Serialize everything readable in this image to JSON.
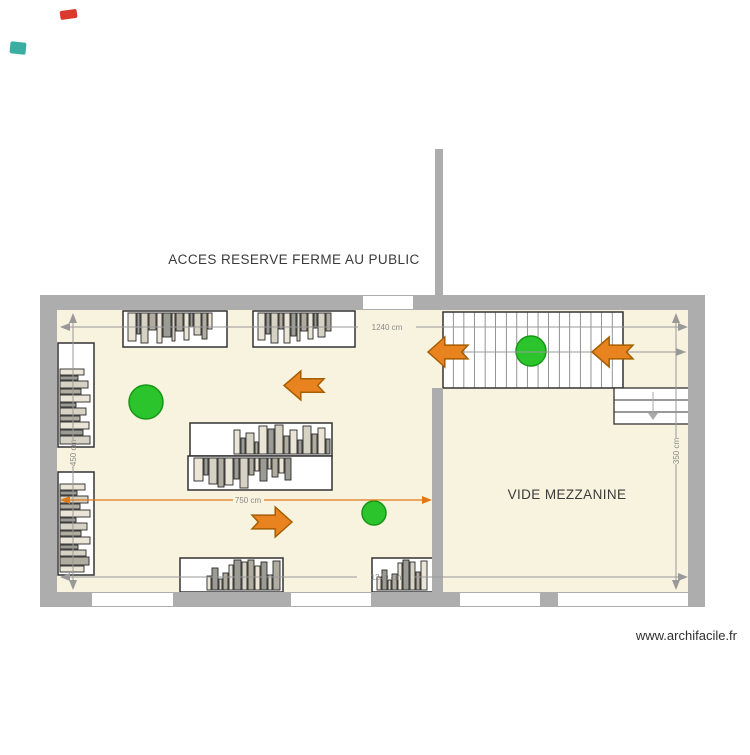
{
  "labels": {
    "access_note": "ACCES RESERVE FERME AU PUBLIC",
    "mezzanine": "VIDE MEZZANINE",
    "watermark": "www.archifacile.fr"
  },
  "dimensions": {
    "top": "1240 cm",
    "bottom": "1240 cm",
    "left": "450 cm",
    "right": "350 cm",
    "room": "750 cm"
  },
  "colors": {
    "wall": "#adadad",
    "floor": "#f8f3de",
    "outline": "#333333",
    "dim_line": "#999999",
    "dim_line_orange": "#e07818",
    "marker_green": "#2cc42c",
    "marker_green_border": "#169616",
    "arrow_orange": "#e8831f",
    "arrow_orange_border": "#a55e00",
    "artifact_red": "#d93a2b",
    "artifact_teal": "#3aaea0"
  },
  "plan": {
    "book_palette": [
      "#eae5d6",
      "#9c9c94",
      "#d6d2c4",
      "#b0aca0"
    ],
    "furniture": [
      {
        "name": "bookshelf-top-left",
        "x": 123,
        "y": 311,
        "w": 104,
        "h": 36,
        "side": "top",
        "books": [
          [
            5,
            8,
            28
          ],
          [
            14,
            3,
            21
          ],
          [
            18,
            7,
            30
          ],
          [
            26,
            7,
            17
          ],
          [
            34,
            5,
            30
          ],
          [
            40,
            8,
            24
          ],
          [
            49,
            3,
            28
          ],
          [
            53,
            7,
            18
          ],
          [
            61,
            5,
            27
          ],
          [
            67,
            3,
            14
          ],
          [
            71,
            7,
            22
          ],
          [
            79,
            5,
            26
          ],
          [
            85,
            4,
            16
          ]
        ]
      },
      {
        "name": "bookshelf-top-right",
        "x": 253,
        "y": 311,
        "w": 102,
        "h": 36,
        "side": "top",
        "books": [
          [
            5,
            7,
            27
          ],
          [
            13,
            4,
            21
          ],
          [
            18,
            7,
            30
          ],
          [
            26,
            4,
            16
          ],
          [
            31,
            6,
            30
          ],
          [
            38,
            5,
            23
          ],
          [
            44,
            3,
            28
          ],
          [
            48,
            6,
            18
          ],
          [
            55,
            5,
            26
          ],
          [
            61,
            3,
            15
          ],
          [
            65,
            7,
            24
          ],
          [
            73,
            5,
            18
          ]
        ]
      },
      {
        "name": "bookshelf-left-wall-upper",
        "x": 58,
        "y": 343,
        "w": 36,
        "h": 104,
        "side": "left",
        "books": [
          [
            26,
            24,
            6
          ],
          [
            33,
            18,
            4
          ],
          [
            38,
            28,
            7
          ],
          [
            46,
            21,
            5
          ],
          [
            52,
            30,
            7
          ],
          [
            60,
            16,
            4
          ],
          [
            65,
            26,
            7
          ],
          [
            73,
            20,
            5
          ],
          [
            79,
            29,
            7
          ],
          [
            87,
            23,
            5
          ],
          [
            93,
            30,
            8
          ]
        ]
      },
      {
        "name": "bookshelf-left-wall-lower",
        "x": 58,
        "y": 472,
        "w": 36,
        "h": 103,
        "side": "left",
        "books": [
          [
            12,
            25,
            6
          ],
          [
            19,
            17,
            4
          ],
          [
            24,
            28,
            7
          ],
          [
            32,
            20,
            5
          ],
          [
            38,
            30,
            7
          ],
          [
            46,
            16,
            4
          ],
          [
            51,
            27,
            7
          ],
          [
            59,
            21,
            5
          ],
          [
            65,
            30,
            7
          ],
          [
            73,
            18,
            4
          ],
          [
            78,
            26,
            6
          ],
          [
            85,
            29,
            8
          ],
          [
            94,
            24,
            6
          ]
        ]
      },
      {
        "name": "bookshelf-center-upper",
        "x": 190,
        "y": 423,
        "w": 142,
        "h": 33,
        "side": "bottom",
        "books": [
          [
            44,
            6,
            24
          ],
          [
            51,
            4,
            16
          ],
          [
            56,
            8,
            21
          ],
          [
            65,
            3,
            12
          ],
          [
            69,
            8,
            28
          ],
          [
            78,
            6,
            25
          ],
          [
            85,
            8,
            29
          ],
          [
            94,
            5,
            18
          ],
          [
            100,
            7,
            24
          ],
          [
            108,
            4,
            14
          ],
          [
            113,
            8,
            28
          ],
          [
            122,
            5,
            20
          ],
          [
            128,
            7,
            26
          ],
          [
            136,
            4,
            15
          ]
        ]
      },
      {
        "name": "bookshelf-center-lower",
        "x": 188,
        "y": 456,
        "w": 144,
        "h": 34,
        "side": "top",
        "books": [
          [
            6,
            9,
            23
          ],
          [
            16,
            4,
            17
          ],
          [
            21,
            8,
            26
          ],
          [
            30,
            6,
            29
          ],
          [
            37,
            8,
            27
          ],
          [
            46,
            5,
            21
          ],
          [
            52,
            8,
            30
          ],
          [
            61,
            5,
            17
          ],
          [
            67,
            4,
            13
          ],
          [
            72,
            7,
            23
          ],
          [
            80,
            3,
            11
          ],
          [
            84,
            6,
            19
          ],
          [
            91,
            5,
            15
          ],
          [
            97,
            6,
            22
          ]
        ]
      },
      {
        "name": "bookshelf-bottom-left",
        "x": 180,
        "y": 558,
        "w": 103,
        "h": 34,
        "side": "bottom",
        "books": [
          [
            27,
            4,
            14
          ],
          [
            32,
            6,
            22
          ],
          [
            39,
            3,
            11
          ],
          [
            43,
            5,
            17
          ],
          [
            49,
            4,
            25
          ],
          [
            54,
            7,
            30
          ],
          [
            62,
            5,
            28
          ],
          [
            68,
            6,
            30
          ],
          [
            75,
            5,
            24
          ],
          [
            81,
            6,
            28
          ],
          [
            88,
            4,
            15
          ],
          [
            93,
            7,
            29
          ]
        ]
      },
      {
        "name": "bookshelf-bottom-right",
        "x": 372,
        "y": 558,
        "w": 61,
        "h": 34,
        "side": "bottom",
        "books": [
          [
            5,
            4,
            13
          ],
          [
            10,
            5,
            20
          ],
          [
            16,
            3,
            10
          ],
          [
            20,
            5,
            16
          ],
          [
            26,
            4,
            27
          ],
          [
            31,
            6,
            30
          ],
          [
            38,
            5,
            28
          ],
          [
            44,
            4,
            18
          ],
          [
            49,
            6,
            29
          ]
        ]
      }
    ],
    "markers": {
      "circles": [
        {
          "cx": 146,
          "cy": 402,
          "r": 17
        },
        {
          "cx": 531,
          "cy": 351,
          "r": 15
        },
        {
          "cx": 374,
          "cy": 513,
          "r": 12
        }
      ],
      "arrows": [
        {
          "x": 284,
          "y": 371,
          "w": 40,
          "h": 29,
          "dir": "left"
        },
        {
          "x": 428,
          "y": 337,
          "w": 40,
          "h": 30,
          "dir": "left"
        },
        {
          "x": 592,
          "y": 337,
          "w": 41,
          "h": 30,
          "dir": "left"
        },
        {
          "x": 252,
          "y": 507,
          "w": 40,
          "h": 30,
          "dir": "right"
        }
      ]
    }
  }
}
